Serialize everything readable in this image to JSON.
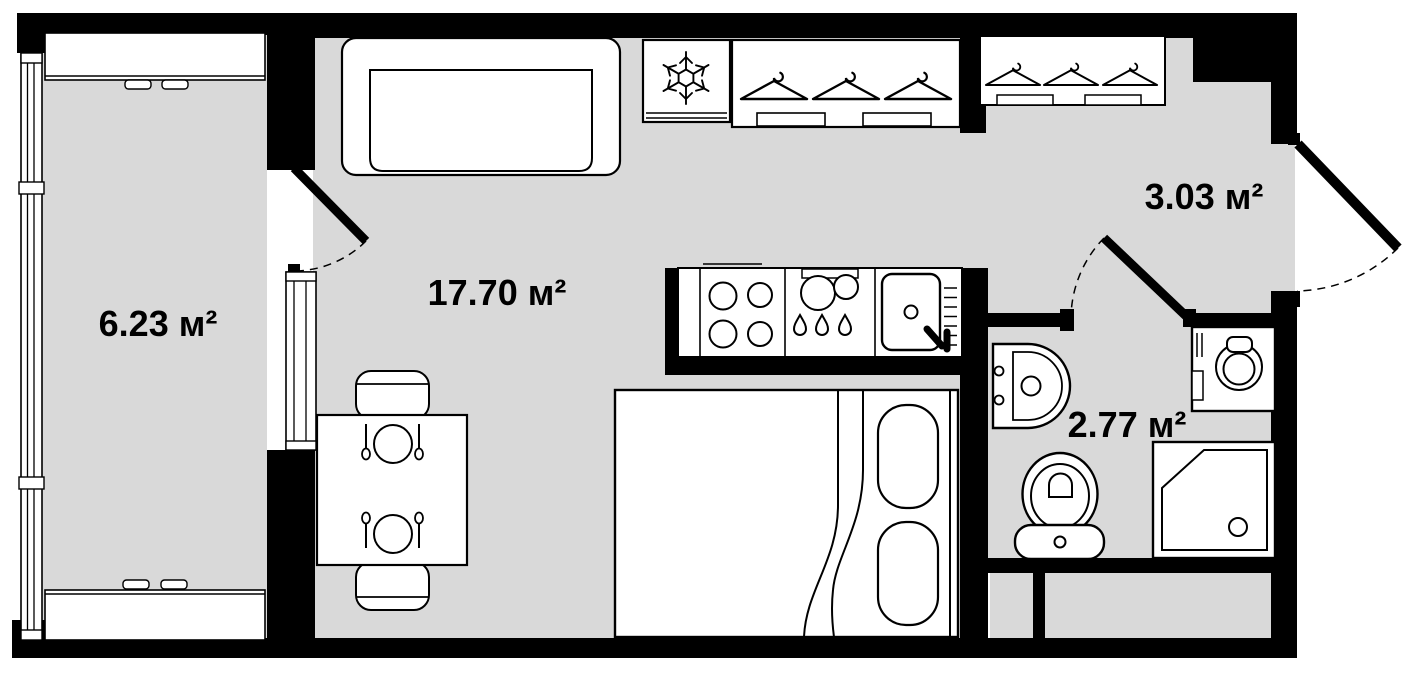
{
  "plan": {
    "background_color": "#ffffff",
    "floor_color": "#d9d9d9",
    "wall_color": "#000000",
    "outline_color": "#000000",
    "rooms": [
      {
        "name": "balcony",
        "area_label": "6.23 м²"
      },
      {
        "name": "living-room",
        "area_label": "17.70 м²"
      },
      {
        "name": "hallway",
        "area_label": "3.03 м²"
      },
      {
        "name": "bathroom",
        "area_label": "2.77 м²"
      }
    ],
    "fixtures": [
      "sofa",
      "fridge",
      "wardrobe",
      "hallway-closet",
      "kitchen-counter",
      "stove",
      "kitchen-sink",
      "dining-table",
      "chair",
      "bed",
      "pillow",
      "washing-machine",
      "wash-basin",
      "toilet",
      "shower",
      "entrance-door",
      "balcony-door",
      "bathroom-door",
      "window"
    ]
  }
}
